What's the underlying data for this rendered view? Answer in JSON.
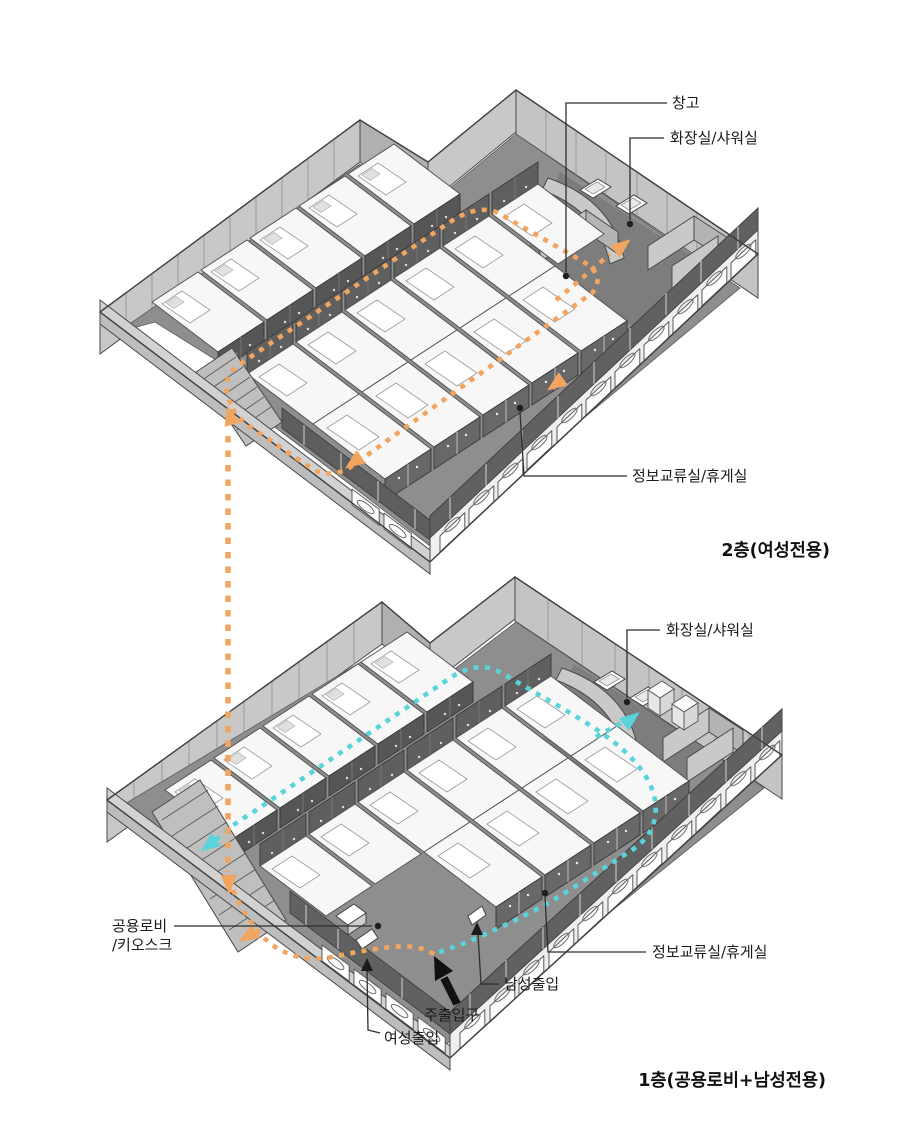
{
  "diagram": {
    "type": "axonometric-floor-plan",
    "floors": {
      "second": {
        "title": "2층(여성전용)"
      },
      "first": {
        "title": "1층(공용로비+남성전용)"
      }
    },
    "labels": {
      "storage": "창고",
      "restroom_2f": "화장실/샤워실",
      "lounge_2f": "정보교류실/휴게실",
      "restroom_1f": "화장실/샤워실",
      "lobby_line1": "공용로비",
      "lobby_line2": "/키오스크",
      "lounge_1f": "정보교류실/휴게실",
      "male_entrance": "남성출입",
      "main_entrance": "주출입구",
      "female_entrance": "여성출입"
    },
    "routes": {
      "female_route_color": "#F2A55F",
      "male_route_color": "#5BD3DB",
      "main_entrance_arrow_color": "#111111"
    }
  }
}
